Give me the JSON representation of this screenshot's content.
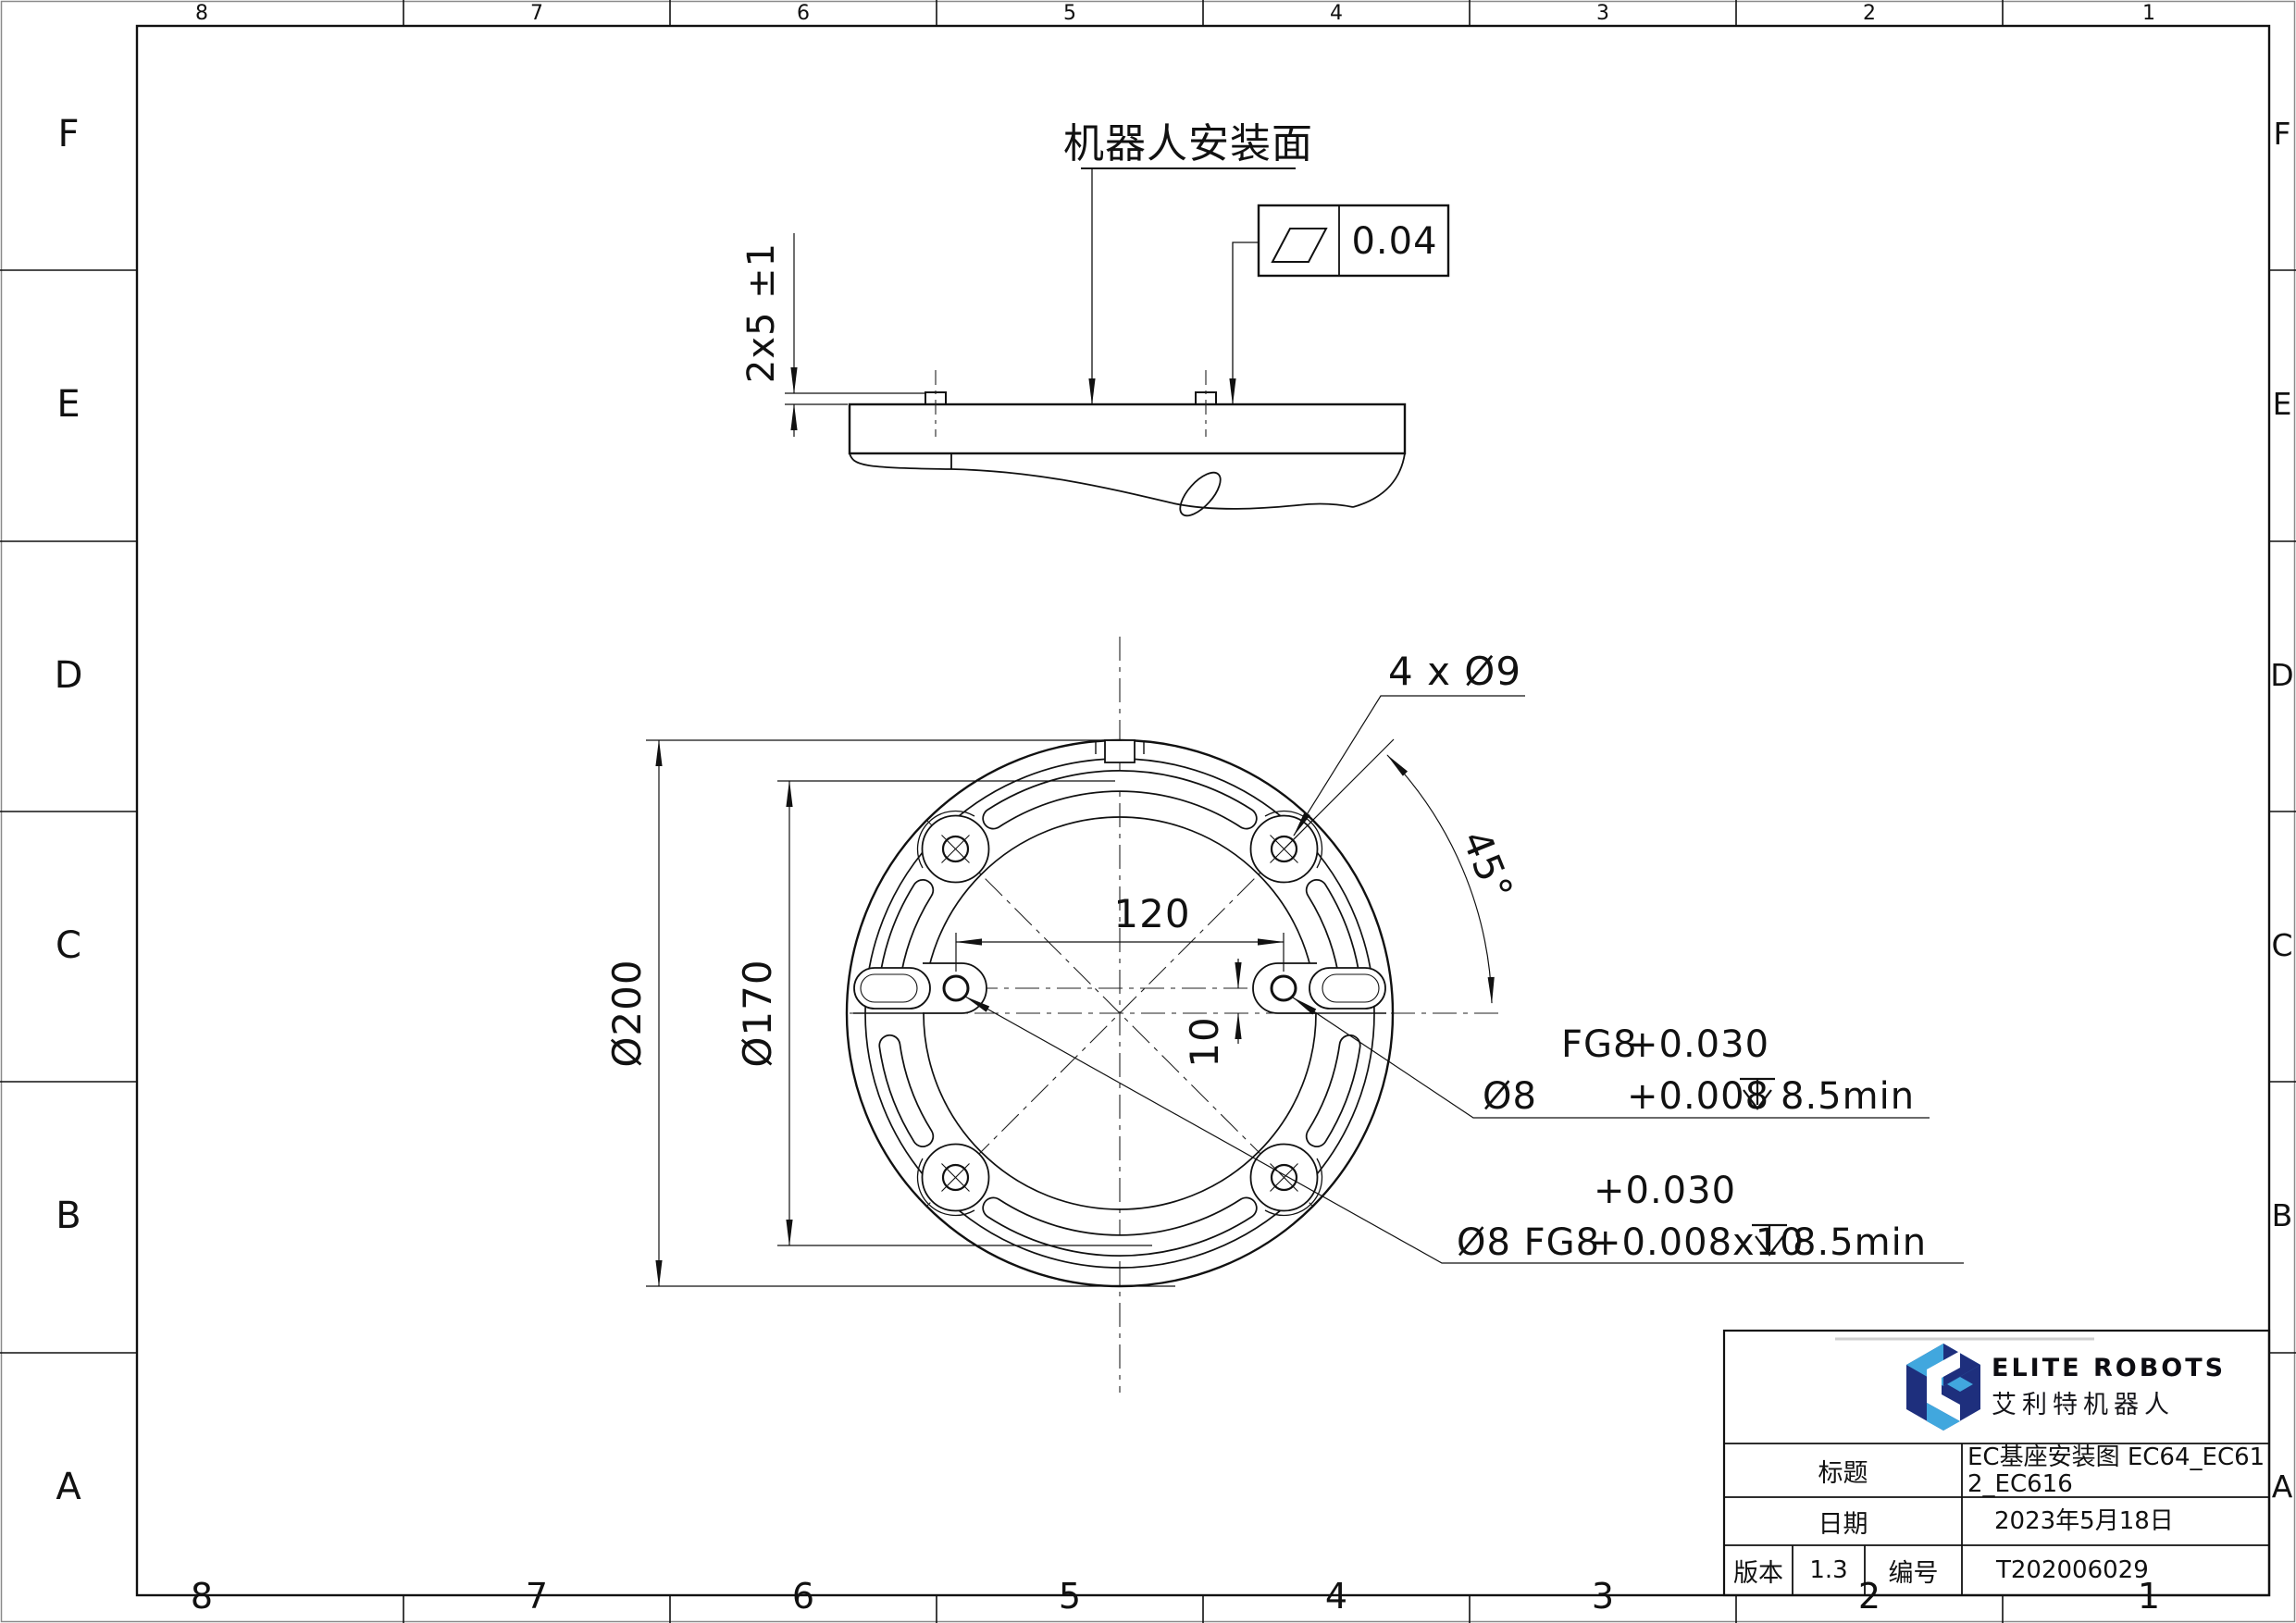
{
  "frame": {
    "zones": [
      "8",
      "7",
      "6",
      "5",
      "4",
      "3",
      "2",
      "1"
    ],
    "rows": [
      "F",
      "E",
      "D",
      "C",
      "B",
      "A"
    ]
  },
  "side_view": {
    "surface_title": "机器人安装面",
    "flatness_symbol": "flatness-parallelogram",
    "flatness_value": "0.04",
    "pin_height_dim": "2x5 ±1"
  },
  "front_view": {
    "hole_callout": "4 x Ø9",
    "angle_dim": "45°",
    "outer_dia": "Ø200",
    "bolt_circle_dia": "Ø170",
    "pin_spacing": "120",
    "pin_offset": "10",
    "pin_callout_1": {
      "line1_fit": "FG8",
      "line1_tol": "+0.030",
      "line2_dia": "Ø8",
      "line2_tol": "+0.008",
      "depth_symbol": "depth-arrow",
      "line2_depth": "8.5min"
    },
    "pin_callout_2": {
      "line1_tol": "+0.030",
      "line2_dia": "Ø8 FG8",
      "line2_tol": "+0.008x10",
      "depth_symbol": "depth-arrow",
      "line2_depth": "8.5min"
    }
  },
  "title_block": {
    "brand_en": "ELITE ROBOTS",
    "brand_cn": "艾利特机器人",
    "title_label": "标题",
    "title_value": "EC基座安装图 EC64_EC612_EC616",
    "date_label": "日期",
    "date_value": "2023年5月18日",
    "version_label": "版本",
    "version_value": "1.3",
    "number_label": "编号",
    "number_value": "T202006029",
    "colors": {
      "logo_light_blue": "#41A7DE",
      "logo_dark_blue": "#1E2F7D",
      "line_black": "#111111"
    }
  }
}
